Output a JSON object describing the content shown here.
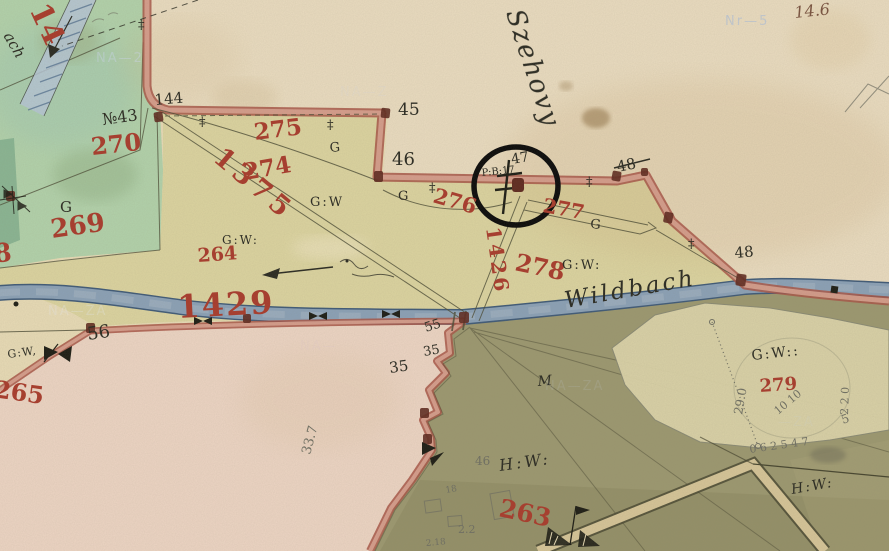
{
  "map_type": "historical-cadastral-map",
  "colors": {
    "paper": "#e8dbb6",
    "cream_region": "#eadcc0",
    "field_yellow": "#dcd4a0",
    "meadow_green": "#b2d2ab",
    "meadow_green_dark": "#7fae8d",
    "pink_field": "#edd5c4",
    "dark_olive": "#9c9870",
    "pale_bulge": "#ddd5aa",
    "river_fill": "#8ba1b7",
    "river_edge": "#3f5a78",
    "boundary_red": "#a85648",
    "boundary_core": "#d9a391",
    "ink": "#2a2a22",
    "red_label": "#a93b2c",
    "pencil": "#6f6f63",
    "node_blob": "#5f2a20",
    "annotation_circle": "#0a0a0a",
    "watermark": "#cdd8ee"
  },
  "t": {
    "p14": "14",
    "p270": "270",
    "p269": "269",
    "p268": "8",
    "p265": "265",
    "p275": "275",
    "p274": "274",
    "p276": "276",
    "p277": "277",
    "p278": "278",
    "p264": "264",
    "p263": "263",
    "p279": "279",
    "r1375": "1375",
    "r1426": "1426",
    "r1429": "1429",
    "v144": "144",
    "v45": "45",
    "v46": "46",
    "v47": "47",
    "v48a": "48",
    "v48b": "48",
    "v56": "56",
    "v55": "55",
    "v35a": "35",
    "v35b": "35",
    "no43": "№43",
    "g1": "G",
    "g2": "G",
    "g3": "G",
    "g4": "G",
    "gw1": "G:W",
    "gw2": "G:W:",
    "gw3": "G:W:",
    "gw4": "G:W,",
    "gw5": "G:W::",
    "hw1": "H:W:",
    "hw2": "H:W:",
    "m": "M",
    "pb": "P:B:17",
    "n146": "14.6",
    "n337": "33.7",
    "n290": "29.0",
    "n1010": "10 10",
    "n220": "2 2 0",
    "n5": "5",
    "seq": "0 6 2 5 4 7",
    "n46": "46",
    "n18": "18",
    "n22": "2.2",
    "n218": "2.18",
    "szehovy": "Szehovy",
    "wildbach": "Wildbach",
    "ach": "ach",
    "wm1": "NA—2",
    "wm2": "Nr—5",
    "wm3": "NA—ZA",
    "wm4": "NA—",
    "wm5": "NA—ZA",
    "wm6": "NA—Z",
    "wm7": "—ZA"
  }
}
